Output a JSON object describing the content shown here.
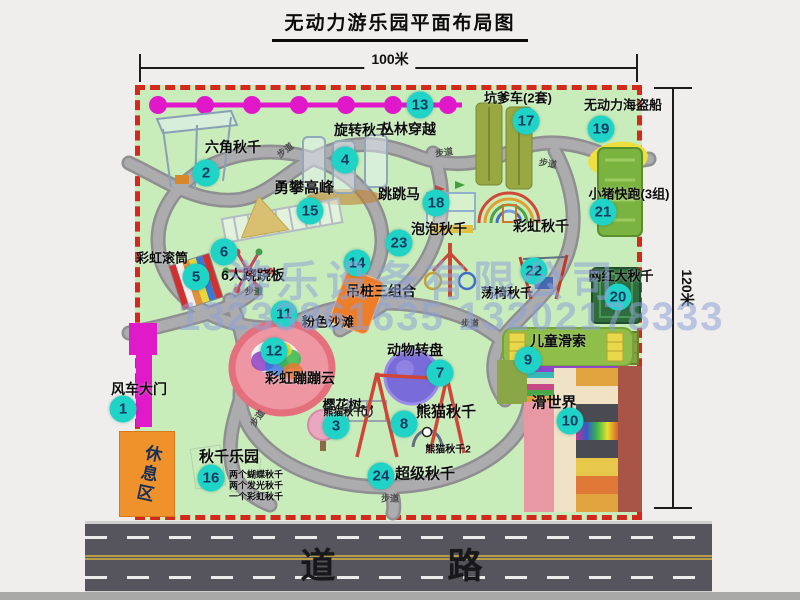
{
  "title": "无动力游乐园平面布局图",
  "dimensions": {
    "top": "100米",
    "right": "120米"
  },
  "road": {
    "label": "道　　路"
  },
  "watermark": {
    "company": "游乐设备有限公司",
    "phones": "13233861635 13202178333"
  },
  "rest_area_label": "休息区",
  "path_label_text": "步道",
  "places": [
    {
      "n": 1,
      "t": "风车大门",
      "lx": 139,
      "ly": 389,
      "bx": 123,
      "by": 409,
      "ls": 14
    },
    {
      "n": 2,
      "t": "六角秋千",
      "lx": 233,
      "ly": 147,
      "bx": 206,
      "by": 173,
      "ls": 14
    },
    {
      "n": 3,
      "t": "樱花树",
      "lx": 342,
      "ly": 404,
      "bx": 336,
      "by": 426,
      "ls": 13
    },
    {
      "n": 4,
      "t": "旋转秋千",
      "lx": 362,
      "ly": 130,
      "bx": 345,
      "by": 160,
      "ls": 14
    },
    {
      "n": 5,
      "t": "彩虹滚筒",
      "lx": 162,
      "ly": 257,
      "bx": 196,
      "by": 277,
      "ls": 13
    },
    {
      "n": 6,
      "t": "6人跷跷板",
      "lx": 253,
      "ly": 275,
      "bx": 224,
      "by": 252,
      "ls": 14
    },
    {
      "n": 7,
      "t": "动物转盘",
      "lx": 415,
      "ly": 350,
      "bx": 440,
      "by": 373,
      "ls": 14
    },
    {
      "n": 8,
      "t": "熊猫秋千",
      "lx": 446,
      "ly": 411,
      "bx": 404,
      "by": 424,
      "ls": 15
    },
    {
      "n": 9,
      "t": "儿童滑索",
      "lx": 558,
      "ly": 341,
      "bx": 528,
      "by": 360,
      "ls": 14
    },
    {
      "n": 10,
      "t": "滑世界",
      "lx": 554,
      "ly": 402,
      "bx": 570,
      "by": 421,
      "ls": 15
    },
    {
      "n": 11,
      "t": "粉色沙滩",
      "lx": 328,
      "ly": 321,
      "bx": 284,
      "by": 314,
      "ls": 13
    },
    {
      "n": 12,
      "t": "彩虹蹦蹦云",
      "lx": 300,
      "ly": 378,
      "bx": 274,
      "by": 351,
      "ls": 14
    },
    {
      "n": 13,
      "t": "丛林穿越",
      "lx": 408,
      "ly": 129,
      "bx": 420,
      "by": 105,
      "ls": 14
    },
    {
      "n": 14,
      "t": "吊桩三组合",
      "lx": 381,
      "ly": 291,
      "bx": 357,
      "by": 263,
      "ls": 14
    },
    {
      "n": 15,
      "t": "勇攀高峰",
      "lx": 304,
      "ly": 187,
      "bx": 310,
      "by": 211,
      "ls": 15
    },
    {
      "n": 16,
      "t": "秋千乐园",
      "lx": 229,
      "ly": 456,
      "bx": 211,
      "by": 478,
      "ls": 15
    },
    {
      "n": 17,
      "t": "坑爹车(2套)",
      "lx": 518,
      "ly": 97,
      "bx": 526,
      "by": 121,
      "ls": 13
    },
    {
      "n": 18,
      "t": "跳跳马",
      "lx": 399,
      "ly": 194,
      "bx": 436,
      "by": 203,
      "ls": 14
    },
    {
      "n": 19,
      "t": "无动力海盗船",
      "lx": 623,
      "ly": 104,
      "bx": 601,
      "by": 129,
      "ls": 13
    },
    {
      "n": 20,
      "t": "网红大秋千",
      "lx": 621,
      "ly": 275,
      "bx": 618,
      "by": 297,
      "ls": 13
    },
    {
      "n": 21,
      "t": "小猪快跑(3组)",
      "lx": 629,
      "ly": 193,
      "bx": 603,
      "by": 212,
      "ls": 13
    },
    {
      "n": 22,
      "t": "荡椅秋千",
      "lx": 507,
      "ly": 292,
      "bx": 534,
      "by": 271,
      "ls": 13
    },
    {
      "n": 23,
      "t": "泡泡秋千",
      "lx": 439,
      "ly": 229,
      "bx": 399,
      "by": 243,
      "ls": 14
    },
    {
      "n": 24,
      "t": "超级秋千",
      "lx": 425,
      "ly": 473,
      "bx": 381,
      "by": 476,
      "ls": 15
    }
  ],
  "extra_labels": [
    {
      "t": "彩虹秋千",
      "x": 541,
      "y": 226,
      "s": 14
    },
    {
      "t": "熊猫秋千1",
      "x": 346,
      "y": 411,
      "s": 10
    },
    {
      "t": "熊猫秋千2",
      "x": 448,
      "y": 448,
      "s": 10
    },
    {
      "t": "两个蝴蝶秋千",
      "x": 256,
      "y": 474,
      "s": 9
    },
    {
      "t": "两个发光秋千",
      "x": 256,
      "y": 485,
      "s": 9
    },
    {
      "t": "一个彩虹秋千",
      "x": 256,
      "y": 496,
      "s": 9
    }
  ],
  "path_labels": [
    {
      "x": 285,
      "y": 150,
      "r": -38
    },
    {
      "x": 444,
      "y": 152,
      "r": -8
    },
    {
      "x": 548,
      "y": 163,
      "r": 10
    },
    {
      "x": 254,
      "y": 291,
      "r": 0
    },
    {
      "x": 470,
      "y": 323,
      "r": 0
    },
    {
      "x": 257,
      "y": 418,
      "r": -55
    },
    {
      "x": 390,
      "y": 498,
      "r": 0
    }
  ]
}
